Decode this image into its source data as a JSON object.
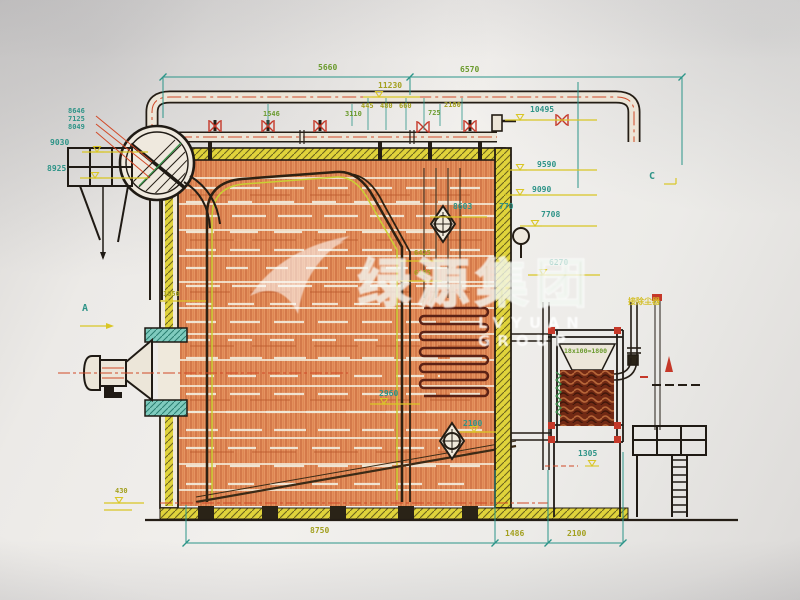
{
  "watermark": {
    "zh": "绿源集团",
    "en": "LVYUAN GROUP"
  },
  "markers": {
    "section_a": "A",
    "section_c": "C"
  },
  "notes": {
    "econ_rows": "18x100=1800",
    "flue_note": "接除尘器"
  },
  "labels": {
    "d5660": "5660",
    "d6570": "6570",
    "d11230": "11230",
    "d445": "445",
    "d480": "480",
    "d660": "660",
    "d2180": "2180",
    "d1546": "1546",
    "d3110": "3110",
    "d725": "725",
    "s8646": "8646",
    "s7125": "7125",
    "s8049": "8049",
    "d9030": "9030",
    "d8925": "8925",
    "d10495": "10495",
    "d9590": "9590",
    "d9090": "9090",
    "d7708": "7708",
    "d6270": "6270",
    "d8603": "8603",
    "d770": "770",
    "d6425": "6425",
    "d6105": "6105",
    "d1050": "1050",
    "d2960": "2960",
    "d2100_mid": "2100",
    "d1305": "1305",
    "d8750": "8750",
    "d1486": "1486",
    "d2100_bottom": "2100",
    "d430": "430"
  },
  "colors": {
    "paper": "#edebe8",
    "line": "#241d15",
    "dim_teal": "#2f9488",
    "dim_green": "#6b9b2e",
    "dim_olive": "#a3a01f",
    "elevation_yellow": "#d8c62c",
    "hatch_orange": "#e29463",
    "hatch_orange_line": "#c2653a",
    "insulation_yellow": "#dfd342",
    "flange_teal": "#82cabe",
    "valve_red": "#c0392b",
    "centerline_red": "#cc4a2a",
    "coil_dark_red": "#6e2a16",
    "watermark_green": "rgba(135,185,135,0.30)"
  }
}
